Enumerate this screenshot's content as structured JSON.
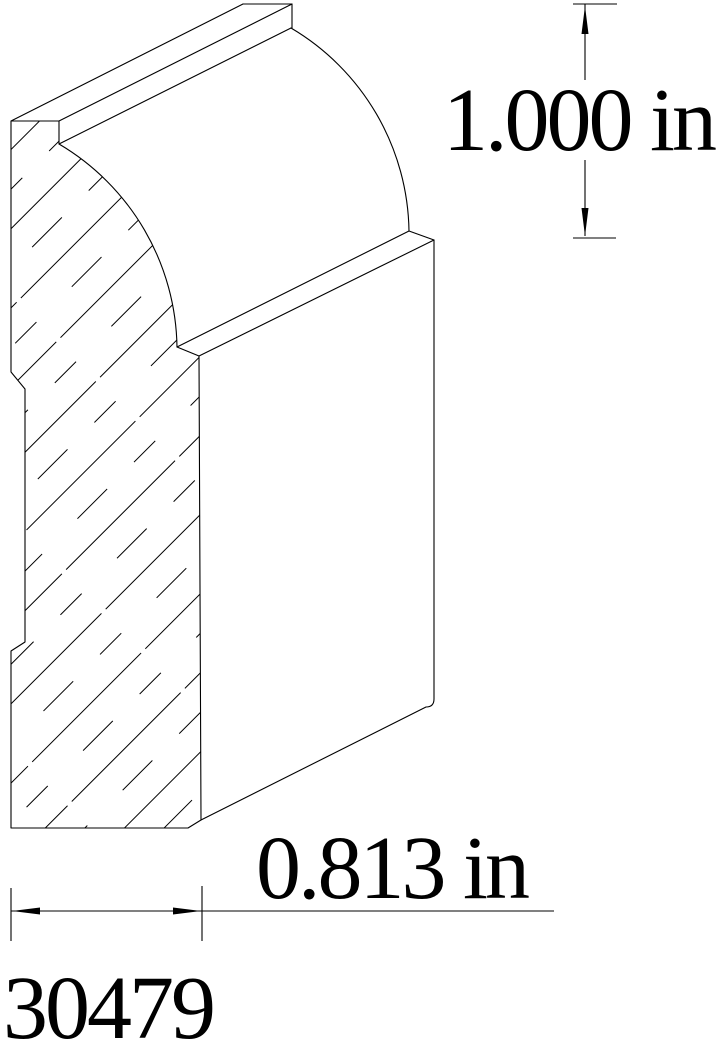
{
  "page": {
    "background": "#ffffff"
  },
  "drawing": {
    "type": "extruded molding profile cross-section (CAD line drawing)",
    "line_color": "#000000",
    "text_color": "#000000",
    "part_number": "30479",
    "dimensions": {
      "height_label": "1.000 in",
      "height_value": "1.000",
      "height_unit": "in",
      "width_label": "0.813 in",
      "width_value": "0.813",
      "width_unit": "in"
    }
  }
}
